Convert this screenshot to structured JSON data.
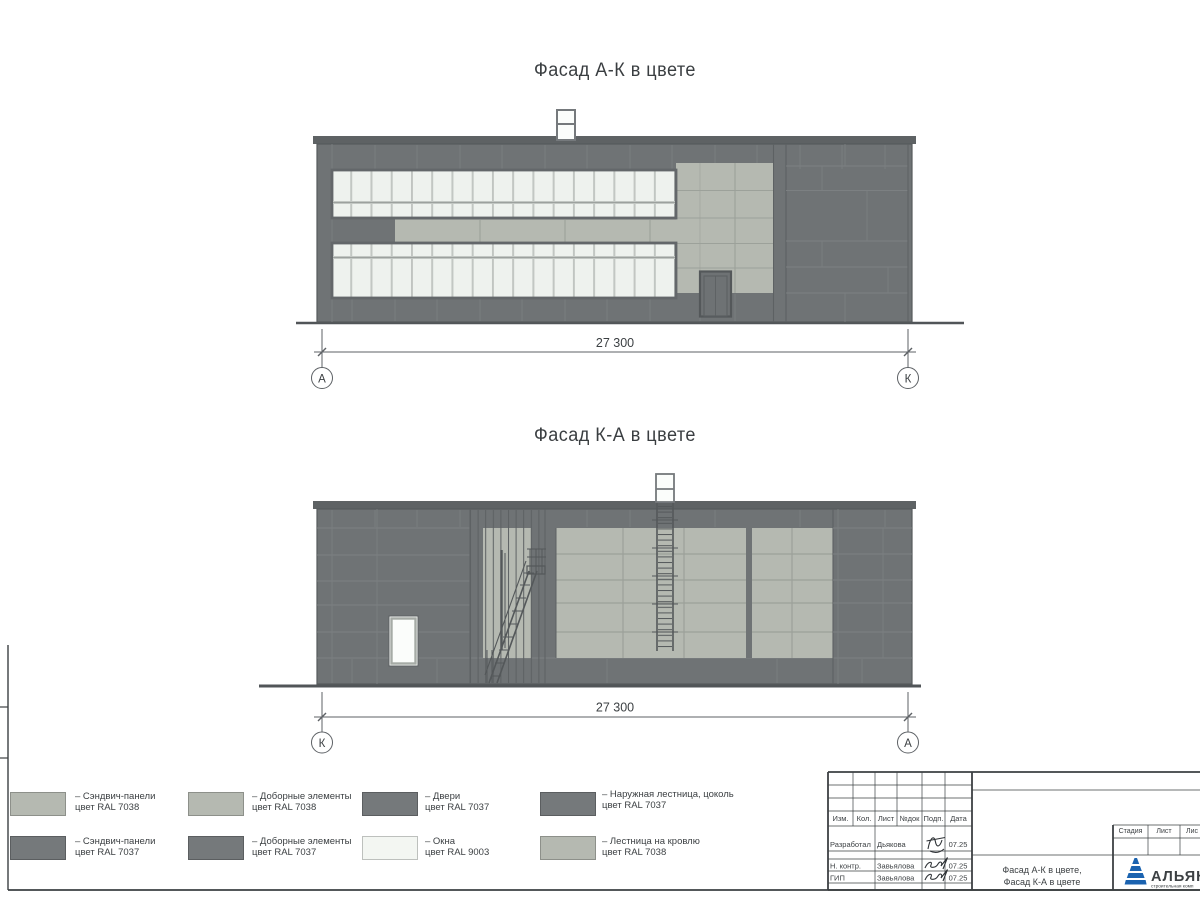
{
  "colors": {
    "wall_ral7037": "#6f7375",
    "panel_ral7038": "#b5b9b1",
    "window_ral9003": "#f0f4f0",
    "parapet_dark": "#5e6264",
    "line_dark": "#3c4043",
    "logo_blue": "#1b63b0"
  },
  "sheet": {
    "facades": [
      {
        "title": "Фасад А-К в цвете",
        "dimension": "27 300",
        "axis_left": "А",
        "axis_right": "К"
      },
      {
        "title": "Фасад К-А в цвете",
        "dimension": "27 300",
        "axis_left": "К",
        "axis_right": "А"
      }
    ],
    "legend": [
      {
        "line1": "– Сэндвич-панели",
        "line2": "цвет RAL 7038",
        "color": "#b5b9b1"
      },
      {
        "line1": "– Доборные элементы",
        "line2": "цвет RAL 7038",
        "color": "#b5b9b1"
      },
      {
        "line1": "– Двери",
        "line2": "цвет RAL 7037",
        "color": "#75797b"
      },
      {
        "line1": "– Наружная лестница, цоколь",
        "line2": "цвет RAL 7037",
        "color": "#75797b"
      },
      {
        "line1": "– Сэндвич-панели",
        "line2": "цвет RAL 7037",
        "color": "#75797b"
      },
      {
        "line1": "– Доборные элементы",
        "line2": "цвет RAL 7037",
        "color": "#75797b"
      },
      {
        "line1": "– Окна",
        "line2": "цвет RAL 9003",
        "color": "#f3f6f2"
      },
      {
        "line1": "– Лестница на кровлю",
        "line2": "цвет RAL 7038",
        "color": "#b5b9b1"
      }
    ],
    "titleblock": {
      "cols": [
        "Изм.",
        "Кол.",
        "Лист",
        "№док",
        "Подп.",
        "Дата"
      ],
      "rows": [
        {
          "role": "Разработал",
          "name": "Дьякова",
          "date": "07.25"
        },
        {
          "role": "Н. контр.",
          "name": "Завьялова",
          "date": "07.25"
        },
        {
          "role": "ГИП",
          "name": "Завьялова",
          "date": "07.25"
        }
      ],
      "doc_line1": "Фасад А-К в цвете,",
      "doc_line2": "Фасад К-А в цвете",
      "stage": "Стадия",
      "sheet": "Лист",
      "sheets": "Лис",
      "company": "АЛЬЯНС",
      "company_sub": "строительная комп"
    }
  }
}
